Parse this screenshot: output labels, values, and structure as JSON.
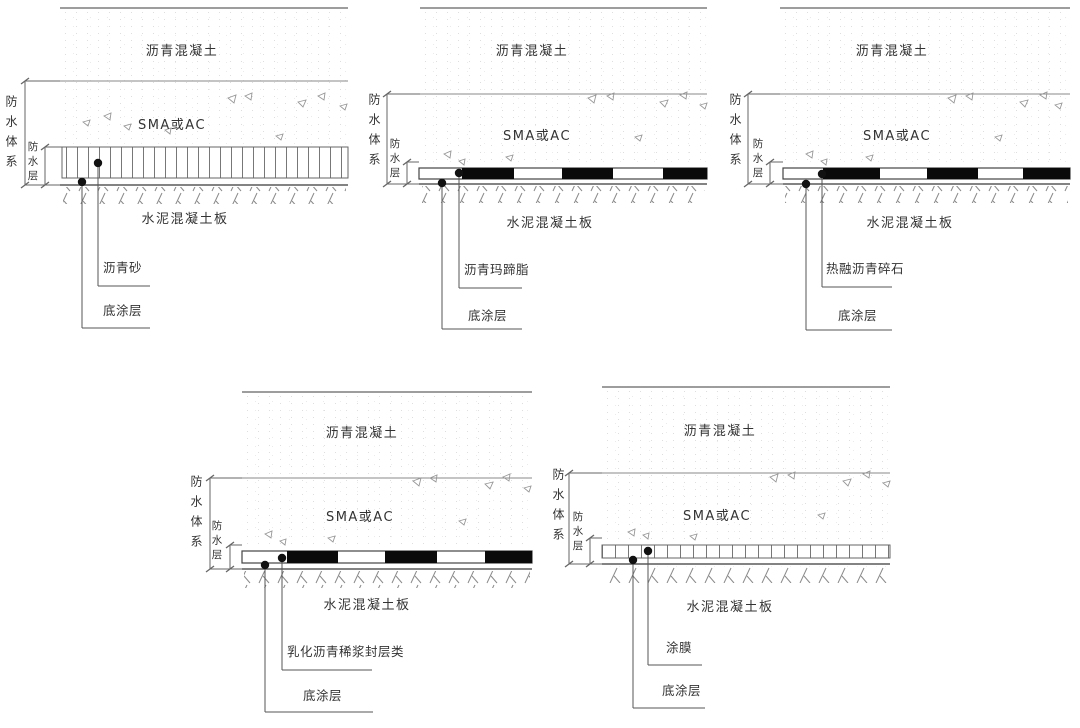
{
  "figure": {
    "description_labels": {
      "system": "防水体系",
      "layer": "防水层"
    }
  },
  "panels": [
    {
      "name": "top-left",
      "asphalt_label": "沥青混凝土",
      "sma_label": "SMA或AC",
      "slab_label": "水泥混凝土板",
      "system_label": "防水体系",
      "waterproof_layer_label": "防水层",
      "material_callout": "沥青砂",
      "primer_callout": "底涂层",
      "band_style": "ticks"
    },
    {
      "name": "top-middle",
      "asphalt_label": "沥青混凝土",
      "sma_label": "SMA或AC",
      "slab_label": "水泥混凝土板",
      "system_label": "防水体系",
      "waterproof_layer_label": "防水层",
      "material_callout": "沥青玛蹄脂",
      "primer_callout": "底涂层",
      "band_style": "blocks"
    },
    {
      "name": "top-right",
      "asphalt_label": "沥青混凝土",
      "sma_label": "SMA或AC",
      "slab_label": "水泥混凝土板",
      "system_label": "防水体系",
      "waterproof_layer_label": "防水层",
      "material_callout": "热融沥青碎石",
      "primer_callout": "底涂层",
      "band_style": "blocks"
    },
    {
      "name": "bottom-left",
      "asphalt_label": "沥青混凝土",
      "sma_label": "SMA或AC",
      "slab_label": "水泥混凝土板",
      "system_label": "防水体系",
      "waterproof_layer_label": "防水层",
      "material_callout": "乳化沥青稀浆封层类",
      "primer_callout": "底涂层",
      "band_style": "blocks"
    },
    {
      "name": "bottom-right",
      "asphalt_label": "沥青混凝土",
      "sma_label": "SMA或AC",
      "slab_label": "水泥混凝土板",
      "system_label": "防水体系",
      "waterproof_layer_label": "防水层",
      "material_callout": "涂膜",
      "primer_callout": "底涂层",
      "band_style": "ticks"
    }
  ]
}
